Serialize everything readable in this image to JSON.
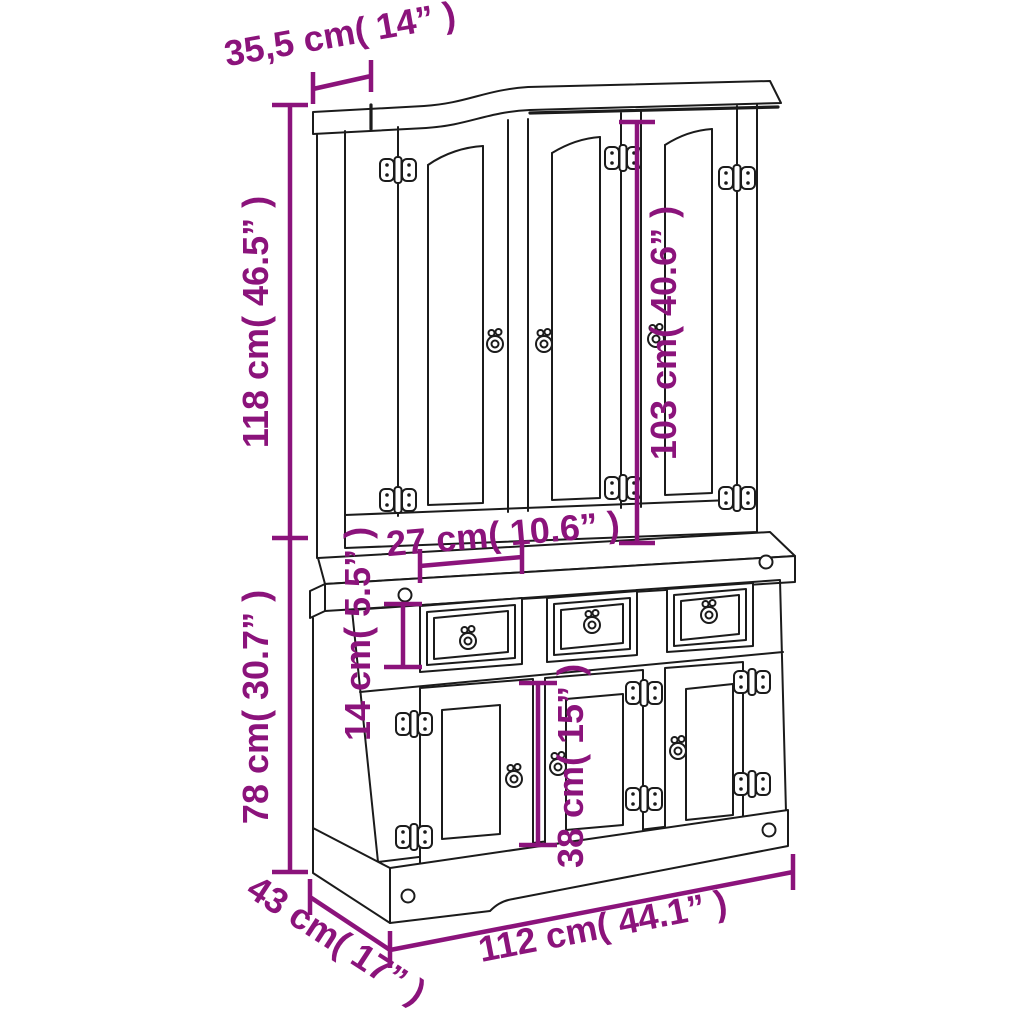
{
  "figure": {
    "type": "furniture-dimension-diagram",
    "subject": "3-door highboard / buffet hutch cabinet line drawing",
    "background_color": "#ffffff",
    "line_color": "#1b1b1b",
    "dimension_color": "#8b137b",
    "icons": [
      "hinge-icon",
      "ring-pull-icon",
      "peg-icon"
    ]
  },
  "dimensions": {
    "top_depth": "35,5 cm( 14” )",
    "hutch_height": "118 cm( 46.5” )",
    "hutch_door_height": "103 cm( 40.6” )",
    "hutch_inner_depth": "27 cm( 10.6” )",
    "drawer_height": "14 cm( 5.5” )",
    "base_height": "78 cm( 30.7” )",
    "base_door_height": "38 cm( 15” )",
    "depth": "43 cm( 17” )",
    "width": "112 cm( 44.1” )"
  }
}
